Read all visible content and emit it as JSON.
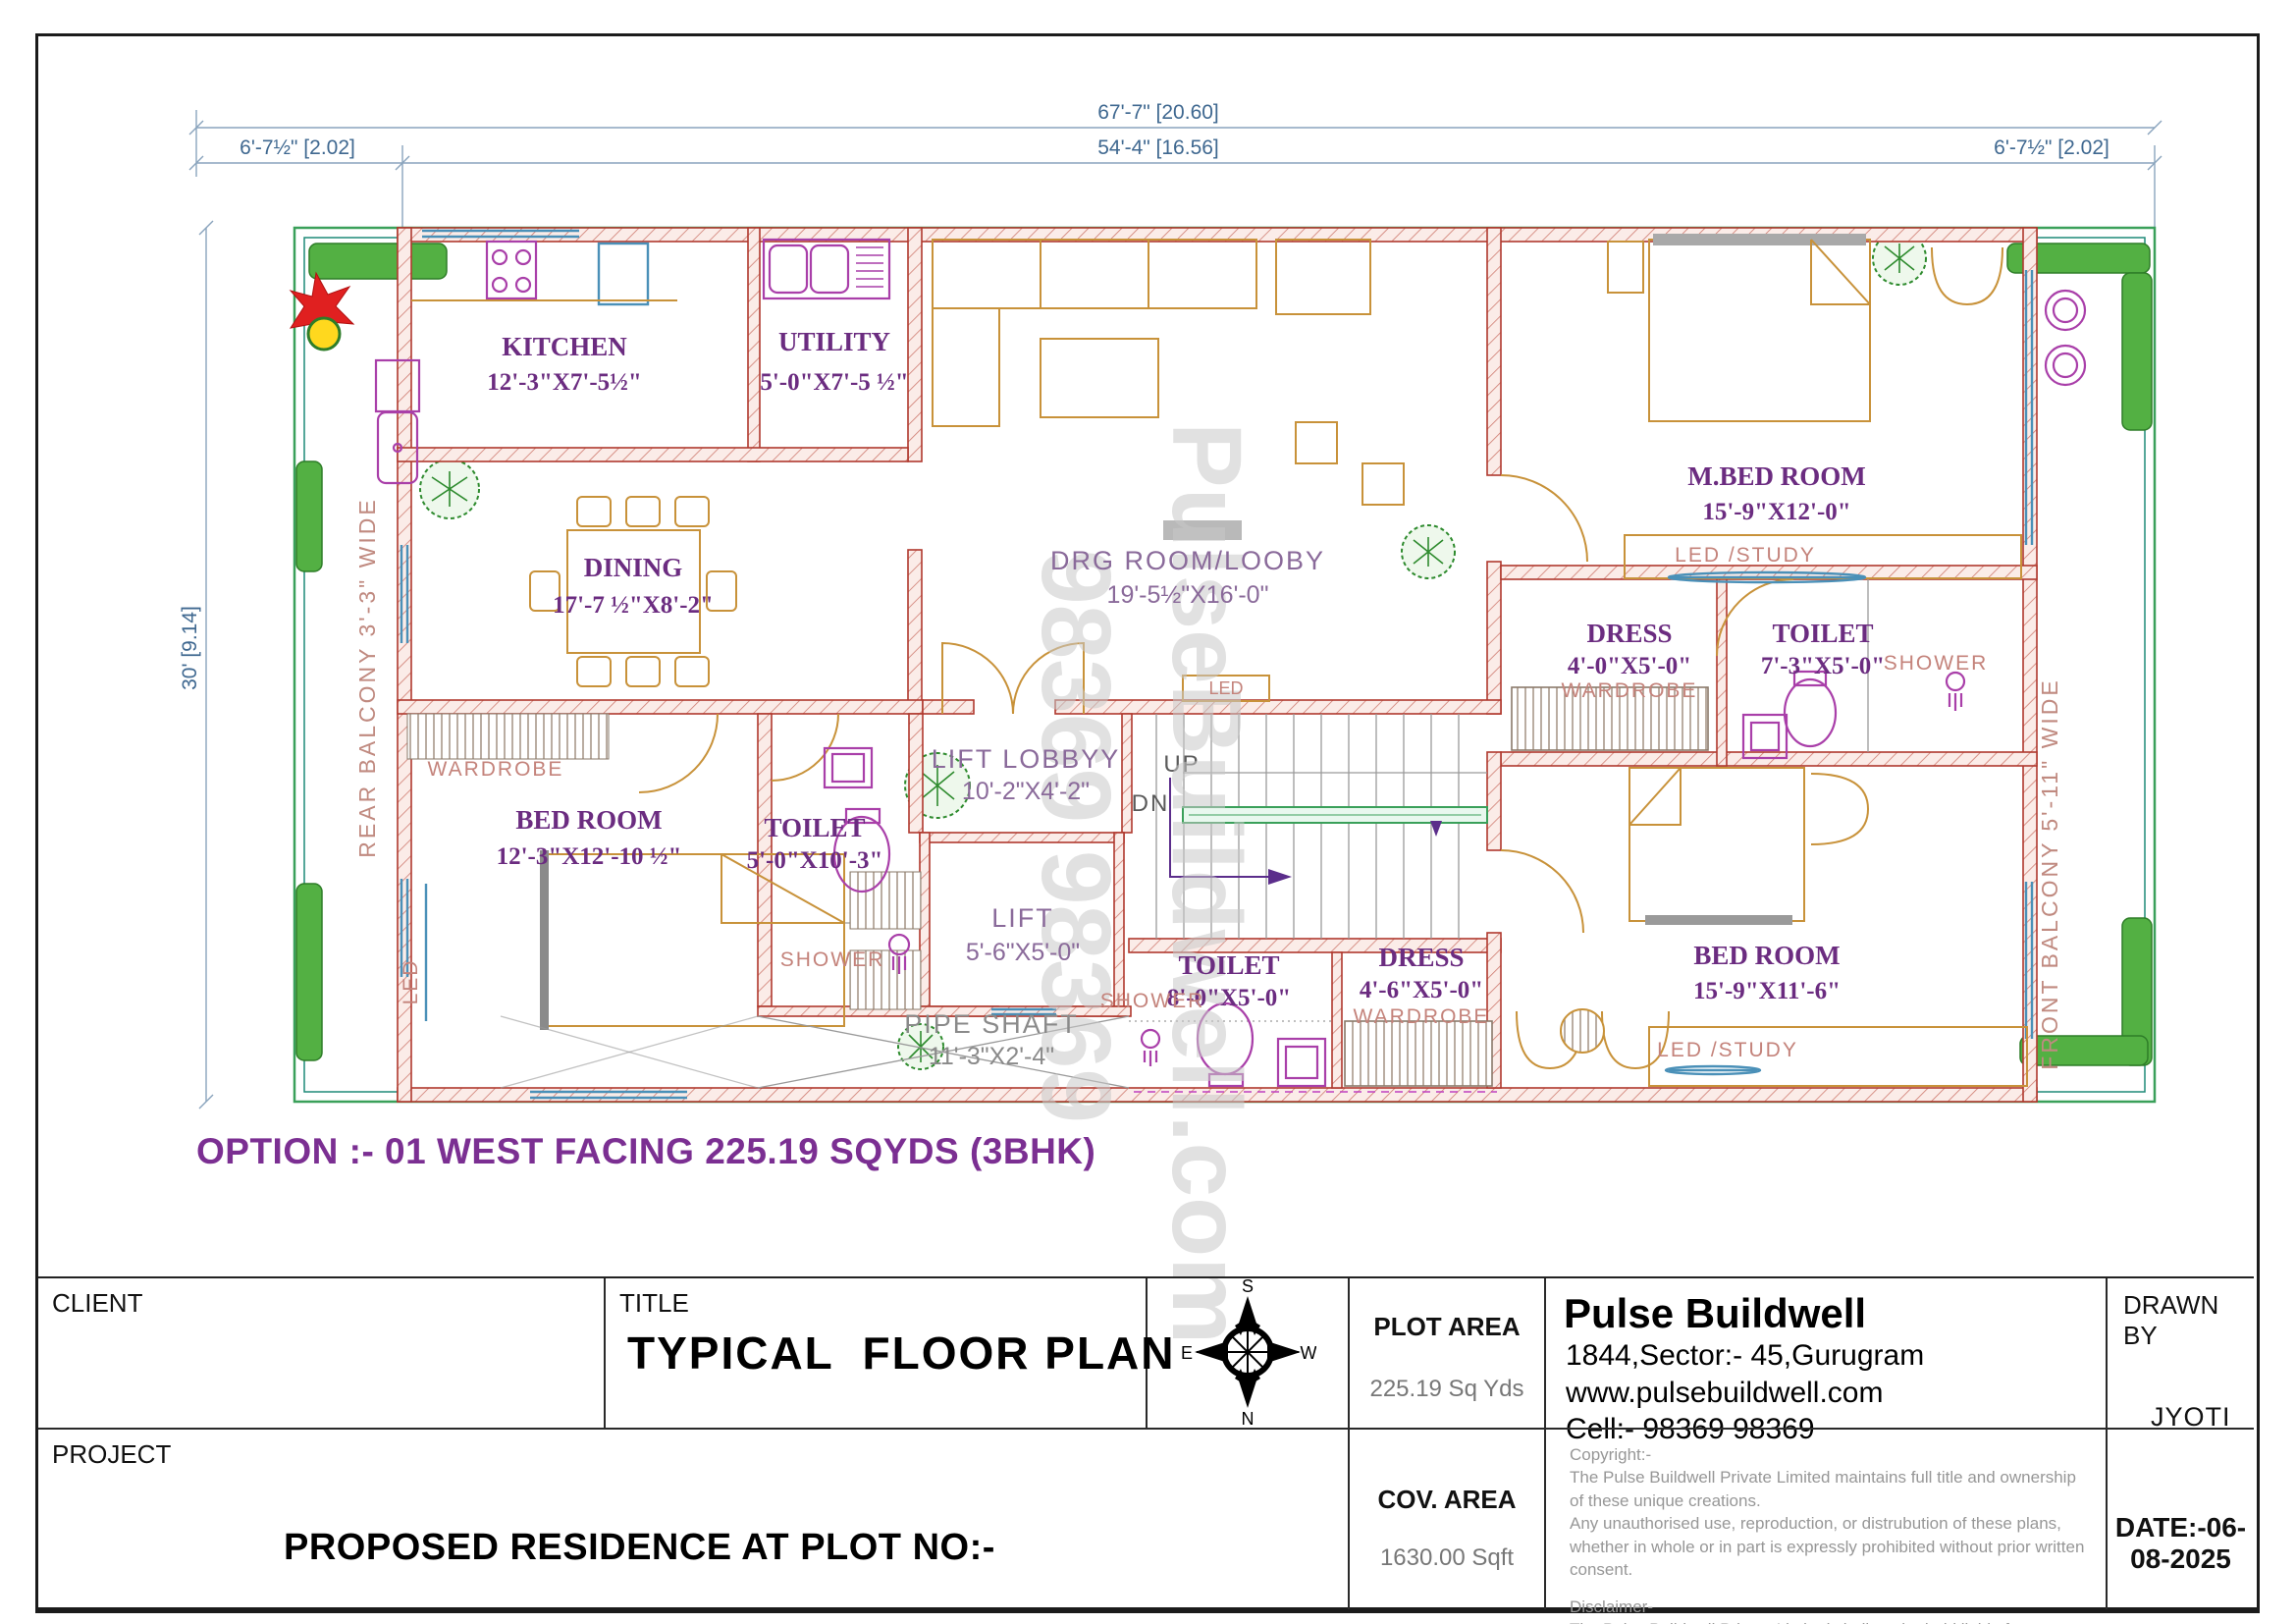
{
  "dims": {
    "overall_w": "67'-7\" [20.60]",
    "side_w": "6'-7½\" [2.02]",
    "inner_w": "54'-4\" [16.56]",
    "height": "30' [9.14]"
  },
  "plan": {
    "balconies": {
      "rear": "REAR BALCONY 3'-3\" WIDE",
      "front": "FRONT BALCONY 5'-11\" WIDE"
    },
    "rooms": {
      "kitchen": {
        "name": "KITCHEN",
        "size": "12'-3\"X7'-5½\""
      },
      "utility": {
        "name": "UTILITY",
        "size": "5'-0\"X7'-5 ½\""
      },
      "dining": {
        "name": "DINING",
        "size": "17'-7 ½\"X8'-2\""
      },
      "drg": {
        "name": "DRG ROOM/LOOBY",
        "size": "19'-5½\"X16'-0\""
      },
      "mbed": {
        "name": "M.BED ROOM",
        "size": "15'-9\"X12'-0\""
      },
      "dress1": {
        "name": "DRESS",
        "size": "4'-0\"X5'-0\""
      },
      "toilet1": {
        "name": "TOILET",
        "size": "7'-3\"X5'-0\""
      },
      "liftlobby": {
        "name": "LIFT LOBBYY",
        "size": "10'-2\"X4'-2\""
      },
      "lift": {
        "name": "LIFT",
        "size": "5'-6\"X5'-0\""
      },
      "pipeshaft": {
        "name": "PIPE SHAFT",
        "size": "11'-3\"X2'-4\""
      },
      "bed1": {
        "name": "BED ROOM",
        "size": "12'-3\"X12'-10 ½\""
      },
      "toilet2": {
        "name": "TOILET",
        "size": "5'-0\"X10'-3\""
      },
      "toilet3": {
        "name": "TOILET",
        "size": "8'-0\"X5'-0\""
      },
      "dress2": {
        "name": "DRESS",
        "size": "4'-6\"X5'-0\""
      },
      "bed2": {
        "name": "BED ROOM",
        "size": "15'-9\"X11'-6\""
      }
    },
    "labels": {
      "up": "UP",
      "dn": "DN",
      "shower": "SHOWER",
      "wardrobe": "WARDROBE",
      "led": "LED",
      "led_study": "LED /STUDY"
    },
    "watermark": {
      "line1": "PulseBuildwell.com",
      "line2": "98369 98369"
    }
  },
  "option_note": "OPTION :- 01 WEST FACING 225.19 SQYDS (3BHK)",
  "title_block": {
    "client_label": "CLIENT",
    "title_label": "TITLE",
    "title_value": "TYPICAL  FLOOR PLAN",
    "compass": {
      "n": "N",
      "s": "S",
      "e": "E",
      "w": "W"
    },
    "plot_area_label": "PLOT AREA",
    "plot_area_value": "225.19 Sq Yds",
    "company": {
      "name": "Pulse Buildwell",
      "address": "1844,Sector:- 45,Gurugram",
      "website": "www.pulsebuildwell.com",
      "cell": "Cell:- 98369 98369"
    },
    "drawn_by_label": "DRAWN BY",
    "drawn_by_value": "JYOTI",
    "project_label": "PROJECT",
    "project_value": "PROPOSED RESIDENCE AT PLOT NO:-",
    "cov_area_label": "COV. AREA",
    "cov_area_value": "1630.00 Sqft",
    "copyright": [
      "Copyright:-",
      "The Pulse Buildwell Private Limited maintains full title and ownership",
      " of these unique creations.",
      "Any unauthorised use, reproduction, or distrubution of these plans,",
      "whether in whole or in part is expressly prohibited without prior written consent.",
      "Disclaimer-",
      "The Pulse Buildwell Private Limited shall not be held liable for any",
      "errors,omissions,or deficiencies in any form by any party whatsoever."
    ],
    "date_value": "DATE:-06-08-2025"
  }
}
